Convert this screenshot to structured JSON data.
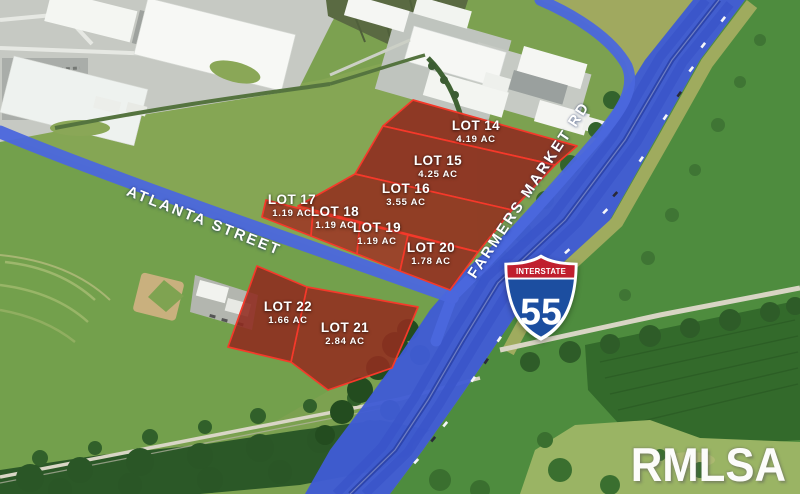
{
  "streets": {
    "atlanta_street": "ATLANTA STREET",
    "farmers_market_rd": "FARMERS MARKET RD"
  },
  "interstate_shield": {
    "header": "INTERSTATE",
    "number": "55"
  },
  "watermark": "RMLSA",
  "lots": [
    {
      "name": "LOT 14",
      "acreage": "4.19 AC"
    },
    {
      "name": "LOT 15",
      "acreage": "4.25 AC"
    },
    {
      "name": "LOT 16",
      "acreage": "3.55 AC"
    },
    {
      "name": "LOT 17",
      "acreage": "1.19 AC"
    },
    {
      "name": "LOT 18",
      "acreage": "1.19 AC"
    },
    {
      "name": "LOT 19",
      "acreage": "1.19 AC"
    },
    {
      "name": "LOT 20",
      "acreage": "1.78 AC"
    },
    {
      "name": "LOT 21",
      "acreage": "2.84 AC"
    },
    {
      "name": "LOT 22",
      "acreage": "1.66 AC"
    }
  ],
  "colors": {
    "lot_fill_dark": "#8F2A1F",
    "lot_fill_light": "#9E3425",
    "lot_border": "#F5392A",
    "road_overlay_blue": "#4B67DD",
    "interstate_blue": "#3F5CD4",
    "shield_red": "#C01F2E",
    "shield_blue": "#1C4EA0",
    "field_green": "#7CA150",
    "tree_green": "#2C5A28"
  }
}
